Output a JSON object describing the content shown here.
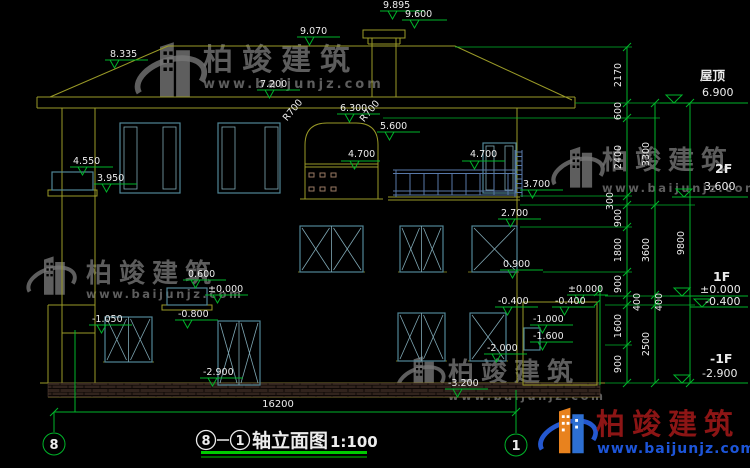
{
  "watermark": {
    "brand": "柏竣建筑",
    "url": "www.baijunjz.com"
  },
  "logo": {
    "brand": "柏竣建筑",
    "url": "www.baijunjz.com"
  },
  "titlebar": {
    "grid_left": "8",
    "grid_right": "1",
    "name": "轴立面图",
    "scale": "1:100"
  },
  "grid": {
    "left_bubble": "8",
    "right_bubble": "1"
  },
  "overall_width": "16200",
  "levels": {
    "roof_label": "屋顶",
    "roof_value": "6.900",
    "f2_label": "2F",
    "f2_value": "3.600",
    "f1_label": "1F",
    "f1_value": "±0.000",
    "f1_value2": "-0.400",
    "b1_label": "-1F",
    "b1_value": "-2.900"
  },
  "elev": {
    "chimney_top": "9.895",
    "chimney_cap": "9.600",
    "ridge": "9.070",
    "left_eave": "8.335",
    "upper_left": "7.200",
    "arch_apex": "6.300",
    "arch_spring": "5.600",
    "arch_ledge": "4.700",
    "balcony_right_top": "4.700",
    "balcony_left_top": "4.550",
    "balcony_left_floor": "3.950",
    "balcony_right_floor": "3.700",
    "window_top": "2.700",
    "window_sill": "0.900",
    "porch_rail": "0.600",
    "porch_floor": "±0.000",
    "door_top": "-0.800",
    "left_ground": "-1.050",
    "base": "-2.900",
    "terrace": "-0.400",
    "stair_ground": "±0.000",
    "stair_top": "-0.400",
    "stair_mid": "-1.000",
    "stair_door": "-1.600",
    "basement_sill": "-2.000",
    "stair_bottom": "-3.200"
  },
  "radius": {
    "left": "R700",
    "right": "R700"
  },
  "dims": {
    "inner": [
      "2170",
      "600",
      "2400",
      "300",
      "900",
      "1800",
      "900",
      "400",
      "1600",
      "900"
    ],
    "mid": [
      "3300",
      "3600",
      "400",
      "2500"
    ],
    "outer": [
      "9800"
    ]
  }
}
